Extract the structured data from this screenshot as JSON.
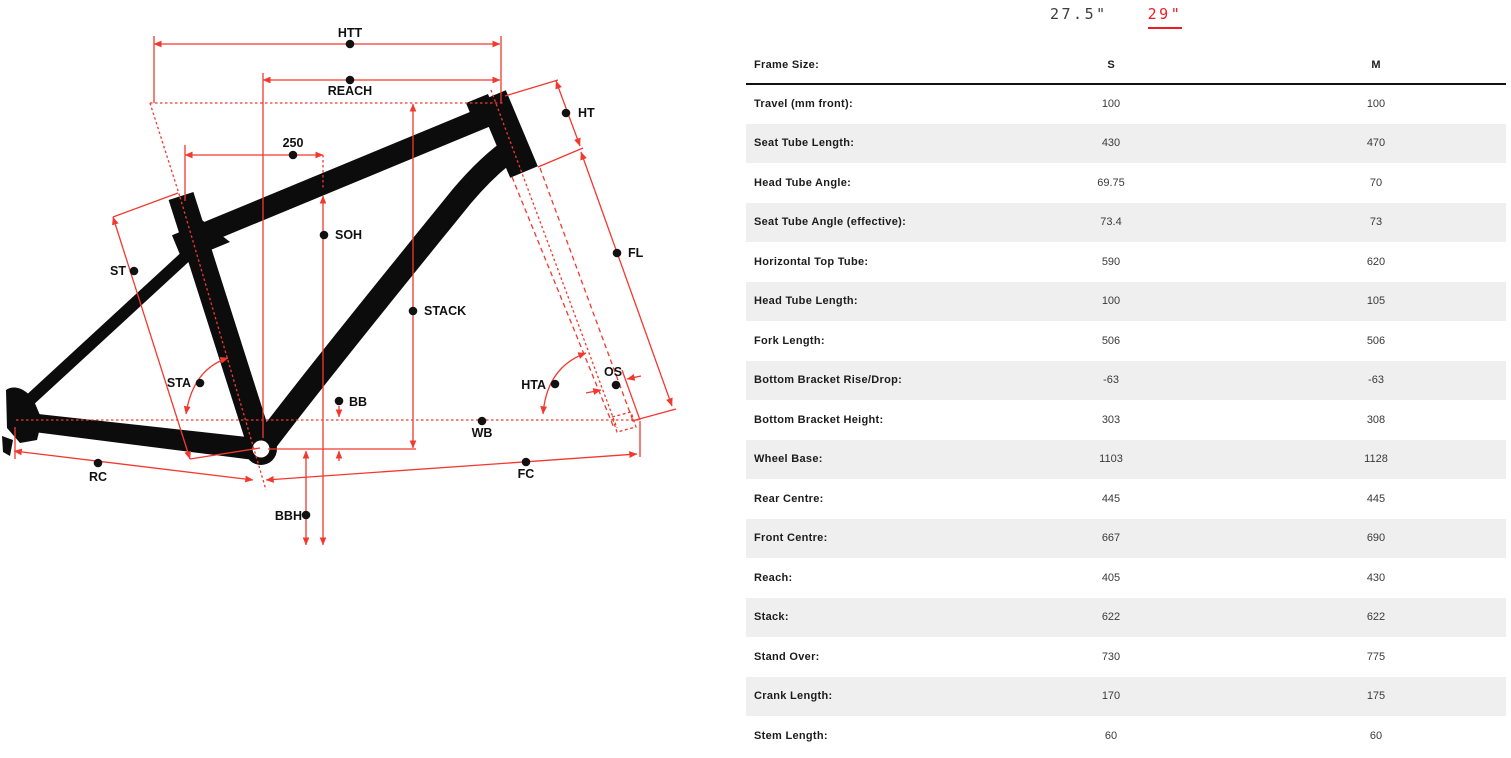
{
  "colors": {
    "accent_red": "#ed1c24",
    "dimension_line_red": "#f2392f",
    "frame_black": "#0c0c0c",
    "row_stripe_gray": "#efefef"
  },
  "wheel_tabs": [
    {
      "label": "27.5\"",
      "active": false
    },
    {
      "label": "29\"",
      "active": true
    }
  ],
  "table": {
    "header": {
      "label": "Frame Size:",
      "columns": [
        "S",
        "M"
      ]
    },
    "rows": [
      {
        "label": "Travel (mm front):",
        "values": [
          "100",
          "100"
        ]
      },
      {
        "label": "Seat Tube Length:",
        "values": [
          "430",
          "470"
        ]
      },
      {
        "label": "Head Tube Angle:",
        "values": [
          "69.75",
          "70"
        ]
      },
      {
        "label": "Seat Tube Angle (effective):",
        "values": [
          "73.4",
          "73"
        ]
      },
      {
        "label": "Horizontal Top Tube:",
        "values": [
          "590",
          "620"
        ]
      },
      {
        "label": "Head Tube Length:",
        "values": [
          "100",
          "105"
        ]
      },
      {
        "label": "Fork Length:",
        "values": [
          "506",
          "506"
        ]
      },
      {
        "label": "Bottom Bracket Rise/Drop:",
        "values": [
          "-63",
          "-63"
        ]
      },
      {
        "label": "Bottom Bracket Height:",
        "values": [
          "303",
          "308"
        ]
      },
      {
        "label": "Wheel Base:",
        "values": [
          "1103",
          "1128"
        ]
      },
      {
        "label": "Rear Centre:",
        "values": [
          "445",
          "445"
        ]
      },
      {
        "label": "Front Centre:",
        "values": [
          "667",
          "690"
        ]
      },
      {
        "label": "Reach:",
        "values": [
          "405",
          "430"
        ]
      },
      {
        "label": "Stack:",
        "values": [
          "622",
          "622"
        ]
      },
      {
        "label": "Stand Over:",
        "values": [
          "730",
          "775"
        ]
      },
      {
        "label": "Crank Length:",
        "values": [
          "170",
          "175"
        ]
      },
      {
        "label": "Stem Length:",
        "values": [
          "60",
          "60"
        ]
      }
    ]
  },
  "diagram": {
    "labels": [
      {
        "text": "HTT",
        "x": 350,
        "y": 37,
        "anchor": "middle",
        "dot": [
          350,
          44
        ]
      },
      {
        "text": "REACH",
        "x": 350,
        "y": 95,
        "anchor": "middle",
        "dot": [
          350,
          80
        ]
      },
      {
        "text": "250",
        "x": 293,
        "y": 147,
        "anchor": "middle",
        "dot": [
          293,
          155
        ]
      },
      {
        "text": "HT",
        "x": 578,
        "y": 117,
        "anchor": "start",
        "dot": [
          566,
          113
        ]
      },
      {
        "text": "SOH",
        "x": 335,
        "y": 239,
        "anchor": "start",
        "dot": [
          324,
          235
        ]
      },
      {
        "text": "ST",
        "x": 126,
        "y": 275,
        "anchor": "end",
        "dot": [
          134,
          271
        ]
      },
      {
        "text": "FL",
        "x": 628,
        "y": 257,
        "anchor": "start",
        "dot": [
          617,
          253
        ]
      },
      {
        "text": "STACK",
        "x": 424,
        "y": 315,
        "anchor": "start",
        "dot": [
          413,
          311
        ]
      },
      {
        "text": "STA",
        "x": 191,
        "y": 387,
        "anchor": "end",
        "dot": [
          200,
          383
        ]
      },
      {
        "text": "BB",
        "x": 349,
        "y": 406,
        "anchor": "start",
        "dot": [
          339,
          401
        ]
      },
      {
        "text": "HTA",
        "x": 546,
        "y": 389,
        "anchor": "end",
        "dot": [
          555,
          384
        ]
      },
      {
        "text": "OS",
        "x": 613,
        "y": 376,
        "anchor": "middle",
        "dot": [
          616,
          385
        ]
      },
      {
        "text": "WB",
        "x": 482,
        "y": 437,
        "anchor": "middle",
        "dot": [
          482,
          421
        ]
      },
      {
        "text": "RC",
        "x": 98,
        "y": 481,
        "anchor": "middle",
        "dot": [
          98,
          463
        ]
      },
      {
        "text": "FC",
        "x": 526,
        "y": 478,
        "anchor": "middle",
        "dot": [
          526,
          462
        ]
      },
      {
        "text": "BBH",
        "x": 302,
        "y": 520,
        "anchor": "end",
        "dot": [
          306,
          515
        ]
      }
    ]
  }
}
